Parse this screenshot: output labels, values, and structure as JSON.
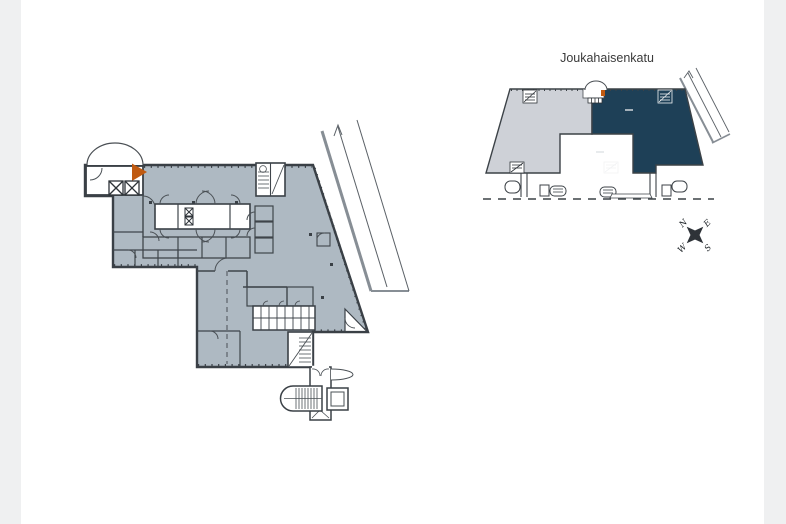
{
  "canvas": {
    "background": "#ffffff",
    "letterbox": "#eff0f1"
  },
  "colors": {
    "plan_fill": "#aeb9c2",
    "wall": "#3a4046",
    "entrance_marker": "#c05a11",
    "overview_highlight": "#1e4057",
    "overview_muted": "#ced1d7",
    "road": "#878e95",
    "white": "#ffffff",
    "text": "#3a3a3a"
  },
  "overview": {
    "street_label": "Joukahaisenkatu",
    "compass": {
      "n": "N",
      "e": "E",
      "s": "S",
      "w": "W"
    }
  }
}
